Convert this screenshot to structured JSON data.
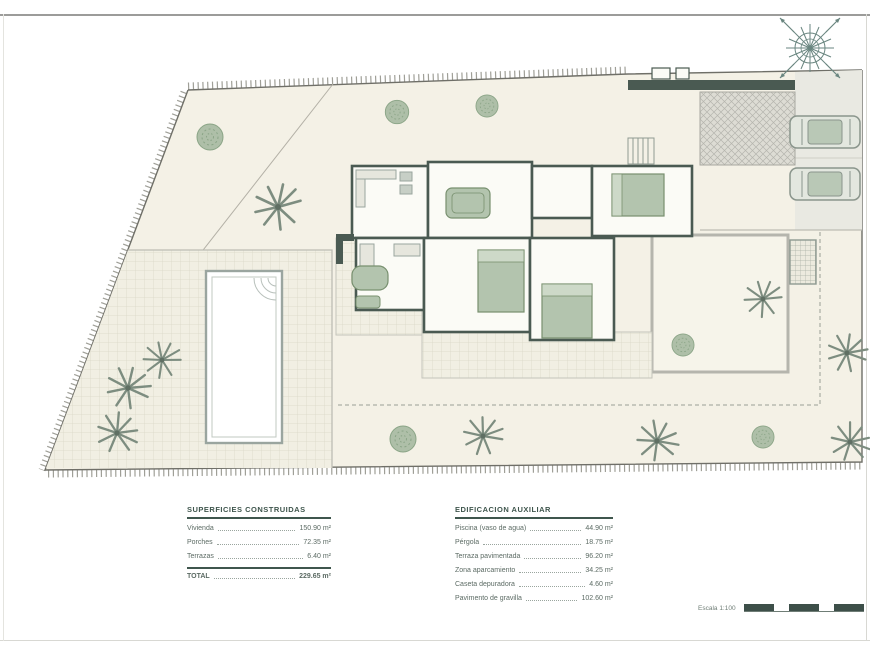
{
  "drawing": {
    "type": "architectural-site-plan",
    "paper_color": "#f4f1e6",
    "wall_color": "#4a5a52",
    "furniture_green": "#b3c4ae",
    "vegetation_green": "#9fb59c",
    "accent_teal": "#3f564d"
  },
  "tables": {
    "built_areas": {
      "title": "SUPERFICIES CONSTRUIDAS",
      "rows": [
        {
          "label": "Vivienda",
          "value": "150.90 m²"
        },
        {
          "label": "Porches",
          "value": "72.35 m²"
        },
        {
          "label": "Terrazas",
          "value": "6.40 m²"
        }
      ],
      "total_rows": [
        {
          "label": "TOTAL",
          "value": "229.65 m²"
        }
      ]
    },
    "auxiliary": {
      "title": "EDIFICACION AUXILIAR",
      "rows": [
        {
          "label": "Piscina (vaso de agua)",
          "value": "44.90 m²"
        },
        {
          "label": "Pérgola",
          "value": "18.75 m²"
        },
        {
          "label": "Terraza pavimentada",
          "value": "96.20 m²"
        },
        {
          "label": "Zona aparcamiento",
          "value": "34.25 m²"
        },
        {
          "label": "Caseta depuradora",
          "value": "4.60 m²"
        },
        {
          "label": "Pavimento de gravilla",
          "value": "102.60 m²"
        }
      ],
      "total_rows": []
    }
  },
  "scale_bar": {
    "label": "Escala 1:100",
    "segments": [
      {
        "w": 30,
        "tone": "dark"
      },
      {
        "w": 15,
        "tone": "light"
      },
      {
        "w": 30,
        "tone": "dark"
      },
      {
        "w": 15,
        "tone": "light"
      },
      {
        "w": 30,
        "tone": "dark"
      }
    ]
  },
  "symbols": {
    "compass": "north-compass-rose",
    "palm_count": 9,
    "bush_count": 6,
    "car_count": 2
  }
}
